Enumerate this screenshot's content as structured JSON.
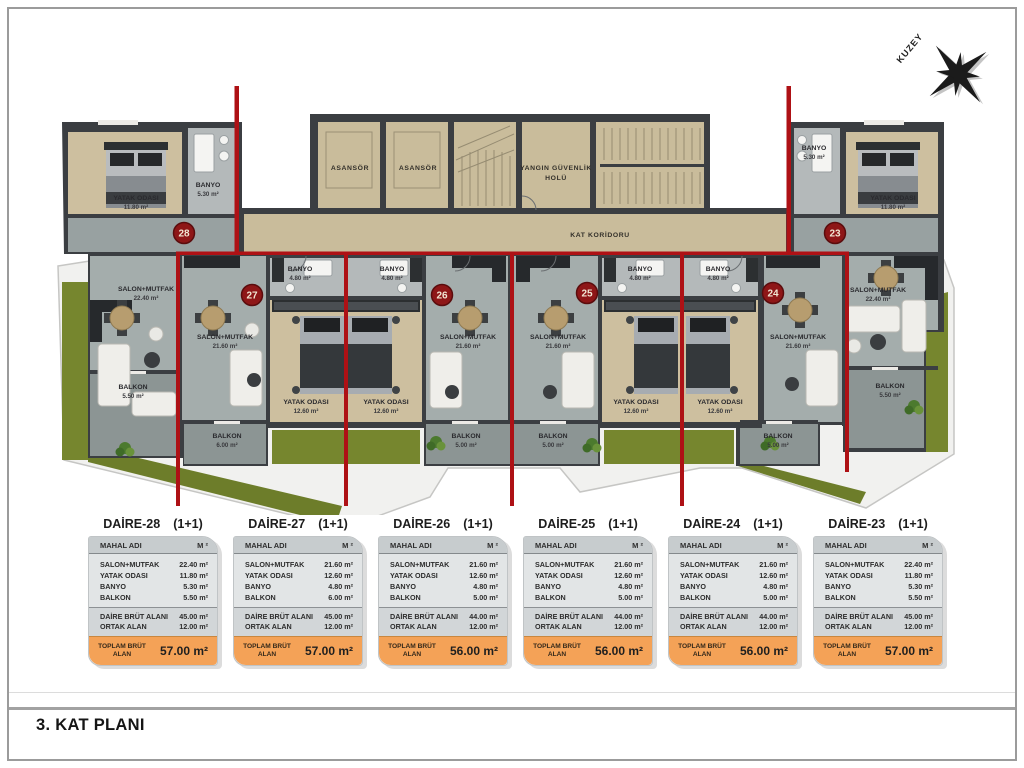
{
  "page": {
    "floor_title": "3. KAT PLANI"
  },
  "compass": {
    "north_label": "KUZEY"
  },
  "common_areas": {
    "elevator_1": "ASANSÖR",
    "elevator_2": "ASANSÖR",
    "fire_hall_line1": "YANGIN GÜVENLİK",
    "fire_hall_line2": "HOLÜ",
    "corridor": "KAT KORİDORU"
  },
  "units": [
    {
      "number": "28",
      "salon_name": "SALON+MUTFAK",
      "salon_area": "22.40 m²",
      "yatak_name": "YATAK ODASI",
      "yatak_area": "11.80 m²",
      "banyo_name": "BANYO",
      "banyo_area": "5.30 m²",
      "balkon_name": "BALKON",
      "balkon_area": "5.50 m²"
    },
    {
      "number": "27",
      "salon_name": "SALON+MUTFAK",
      "salon_area": "21.60 m²",
      "yatak_name": "YATAK ODASI",
      "yatak_area": "12.60 m²",
      "banyo_name": "BANYO",
      "banyo_area": "4.80 m²",
      "balkon_name": "BALKON",
      "balkon_area": "6.00 m²"
    },
    {
      "number": "26",
      "salon_name": "SALON+MUTFAK",
      "salon_area": "21.60 m²",
      "yatak_name": "YATAK ODASI",
      "yatak_area": "12.60 m²",
      "banyo_name": "BANYO",
      "banyo_area": "4.80 m²",
      "balkon_name": "BALKON",
      "balkon_area": "5.00 m²"
    },
    {
      "number": "25",
      "salon_name": "SALON+MUTFAK",
      "salon_area": "21.60 m²",
      "yatak_name": "YATAK ODASI",
      "yatak_area": "12.60 m²",
      "banyo_name": "BANYO",
      "banyo_area": "4.80 m²",
      "balkon_name": "BALKON",
      "balkon_area": "5.00 m²"
    },
    {
      "number": "24",
      "salon_name": "SALON+MUTFAK",
      "salon_area": "21.60 m²",
      "yatak_name": "YATAK ODASI",
      "yatak_area": "12.60 m²",
      "banyo_name": "BANYO",
      "banyo_area": "4.80 m²",
      "balkon_name": "BALKON",
      "balkon_area": "5.00 m²"
    },
    {
      "number": "23",
      "salon_name": "SALON+MUTFAK",
      "salon_area": "22.40 m²",
      "yatak_name": "YATAK ODASI",
      "yatak_area": "11.80 m²",
      "banyo_name": "BANYO",
      "banyo_area": "5.30 m²",
      "balkon_name": "BALKON",
      "balkon_area": "5.50 m²"
    }
  ],
  "tables": [
    {
      "title": "DAİRE-28",
      "type_label": "(1+1)",
      "col_room": "MAHAL ADI",
      "col_area": "M ²",
      "rows": [
        {
          "label": "SALON+MUTFAK",
          "value": "22.40 m²"
        },
        {
          "label": "YATAK ODASI",
          "value": "11.80 m²"
        },
        {
          "label": "BANYO",
          "value": "5.30 m²"
        },
        {
          "label": "BALKON",
          "value": "5.50 m²"
        }
      ],
      "gross_rows": [
        {
          "label": "DAİRE BRÜT ALANI",
          "value": "45.00 m²"
        },
        {
          "label": "ORTAK ALAN",
          "value": "12.00 m²"
        }
      ],
      "total_label": "TOPLAM BRÜT ALAN",
      "total_value": "57.00 m²"
    },
    {
      "title": "DAİRE-27",
      "type_label": "(1+1)",
      "col_room": "MAHAL ADI",
      "col_area": "M ²",
      "rows": [
        {
          "label": "SALON+MUTFAK",
          "value": "21.60 m²"
        },
        {
          "label": "YATAK ODASI",
          "value": "12.60 m²"
        },
        {
          "label": "BANYO",
          "value": "4.80 m²"
        },
        {
          "label": "BALKON",
          "value": "6.00 m²"
        }
      ],
      "gross_rows": [
        {
          "label": "DAİRE BRÜT ALANI",
          "value": "45.00 m²"
        },
        {
          "label": "ORTAK ALAN",
          "value": "12.00 m²"
        }
      ],
      "total_label": "TOPLAM BRÜT ALAN",
      "total_value": "57.00 m²"
    },
    {
      "title": "DAİRE-26",
      "type_label": "(1+1)",
      "col_room": "MAHAL ADI",
      "col_area": "M ²",
      "rows": [
        {
          "label": "SALON+MUTFAK",
          "value": "21.60 m²"
        },
        {
          "label": "YATAK ODASI",
          "value": "12.60 m²"
        },
        {
          "label": "BANYO",
          "value": "4.80 m²"
        },
        {
          "label": "BALKON",
          "value": "5.00 m²"
        }
      ],
      "gross_rows": [
        {
          "label": "DAİRE BRÜT ALANI",
          "value": "44.00 m²"
        },
        {
          "label": "ORTAK ALAN",
          "value": "12.00 m²"
        }
      ],
      "total_label": "TOPLAM BRÜT ALAN",
      "total_value": "56.00 m²"
    },
    {
      "title": "DAİRE-25",
      "type_label": "(1+1)",
      "col_room": "MAHAL ADI",
      "col_area": "M ²",
      "rows": [
        {
          "label": "SALON+MUTFAK",
          "value": "21.60 m²"
        },
        {
          "label": "YATAK ODASI",
          "value": "12.60 m²"
        },
        {
          "label": "BANYO",
          "value": "4.80 m²"
        },
        {
          "label": "BALKON",
          "value": "5.00 m²"
        }
      ],
      "gross_rows": [
        {
          "label": "DAİRE BRÜT ALANI",
          "value": "44.00 m²"
        },
        {
          "label": "ORTAK ALAN",
          "value": "12.00 m²"
        }
      ],
      "total_label": "TOPLAM BRÜT ALAN",
      "total_value": "56.00 m²"
    },
    {
      "title": "DAİRE-24",
      "type_label": "(1+1)",
      "col_room": "MAHAL ADI",
      "col_area": "M ²",
      "rows": [
        {
          "label": "SALON+MUTFAK",
          "value": "21.60 m²"
        },
        {
          "label": "YATAK ODASI",
          "value": "12.60 m²"
        },
        {
          "label": "BANYO",
          "value": "4.80 m²"
        },
        {
          "label": "BALKON",
          "value": "5.00 m²"
        }
      ],
      "gross_rows": [
        {
          "label": "DAİRE BRÜT ALANI",
          "value": "44.00 m²"
        },
        {
          "label": "ORTAK ALAN",
          "value": "12.00 m²"
        }
      ],
      "total_label": "TOPLAM BRÜT ALAN",
      "total_value": "56.00 m²"
    },
    {
      "title": "DAİRE-23",
      "type_label": "(1+1)",
      "col_room": "MAHAL ADI",
      "col_area": "M ²",
      "rows": [
        {
          "label": "SALON+MUTFAK",
          "value": "22.40 m²"
        },
        {
          "label": "YATAK ODASI",
          "value": "11.80 m²"
        },
        {
          "label": "BANYO",
          "value": "5.30 m²"
        },
        {
          "label": "BALKON",
          "value": "5.50 m²"
        }
      ],
      "gross_rows": [
        {
          "label": "DAİRE BRÜT ALANI",
          "value": "45.00 m²"
        },
        {
          "label": "ORTAK ALAN",
          "value": "12.00 m²"
        }
      ],
      "total_label": "TOPLAM BRÜT ALAN",
      "total_value": "57.00 m²"
    }
  ]
}
